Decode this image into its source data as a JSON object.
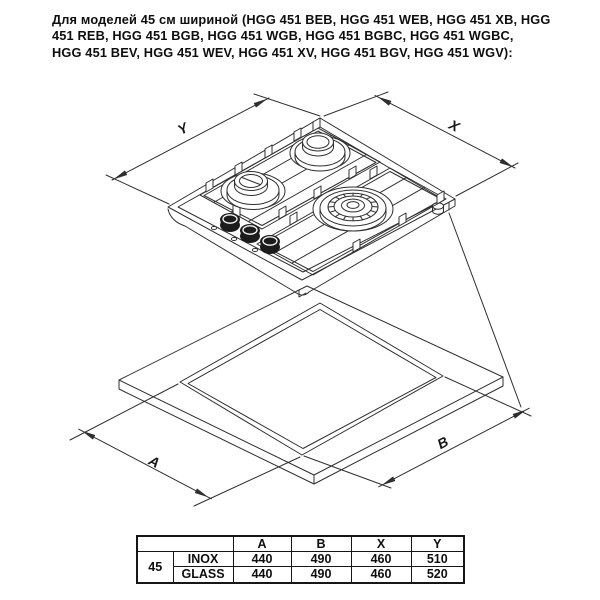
{
  "header": {
    "lines": [
      "Для моделей 45 см шириной (HGG 451 BEB, HGG 451 WEB, HGG 451 XB, HGG",
      "451 REB, HGG 451 BGB, HGG 451 WGB, HGG 451 BGBC, HGG 451 WGBC,",
      "HGG 451 BEV, HGG 451 WEV, HGG 451 XV, HGG 451 BGV, HGG 451 WGV):"
    ]
  },
  "diagram": {
    "description": "isometric gas hob above worktop cutout",
    "labels": {
      "y": "Y",
      "x": "X",
      "a": "A",
      "b": "B"
    }
  },
  "dimensions_table": {
    "size_label": "45",
    "col_headers": [
      "A",
      "B",
      "X",
      "Y"
    ],
    "rows": [
      {
        "finish": "INOX",
        "values": [
          "440",
          "490",
          "460",
          "510"
        ]
      },
      {
        "finish": "GLASS",
        "values": [
          "440",
          "490",
          "460",
          "520"
        ]
      }
    ]
  },
  "colors": {
    "line": "#2f2f2f",
    "text": "#0e0e0e",
    "background": "#ffffff"
  }
}
